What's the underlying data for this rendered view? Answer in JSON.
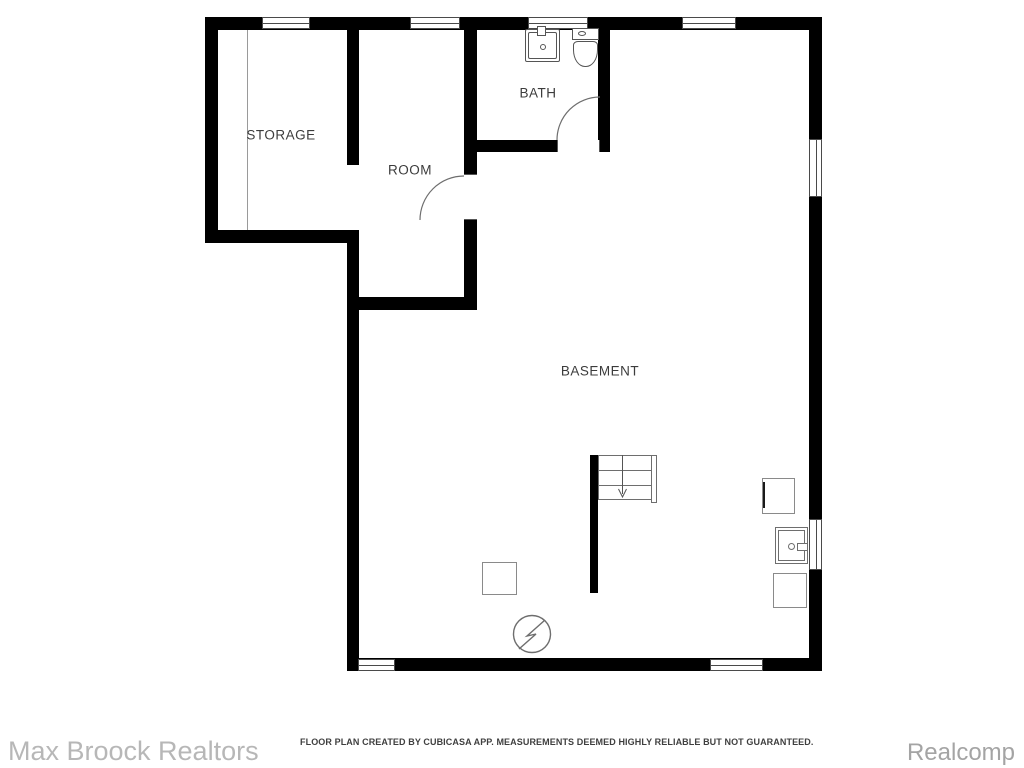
{
  "plan": {
    "labels": {
      "storage": "STORAGE",
      "room": "ROOM",
      "bath": "BATH",
      "basement": "BASEMENT"
    },
    "symbols": [
      "window",
      "door-swing",
      "bathroom-sink",
      "toilet",
      "staircase-down-arrow",
      "electrical-panel",
      "utility-sink",
      "appliance-square"
    ]
  },
  "footer": {
    "disclaimer": "FLOOR PLAN CREATED BY CUBICASA APP. MEASUREMENTS DEEMED HIGHLY RELIABLE BUT NOT GUARANTEED.",
    "watermark_left": "Max Broock Realtors",
    "watermark_right": "Realcomp"
  },
  "colors": {
    "wall": "#000000",
    "fixture": "#6e6e6e",
    "label": "#3c3c3c",
    "disclaimer": "#3f3f3f",
    "watermark_left": "#b7b7b7",
    "watermark_right": "#a4a4a4",
    "background": "#ffffff"
  }
}
